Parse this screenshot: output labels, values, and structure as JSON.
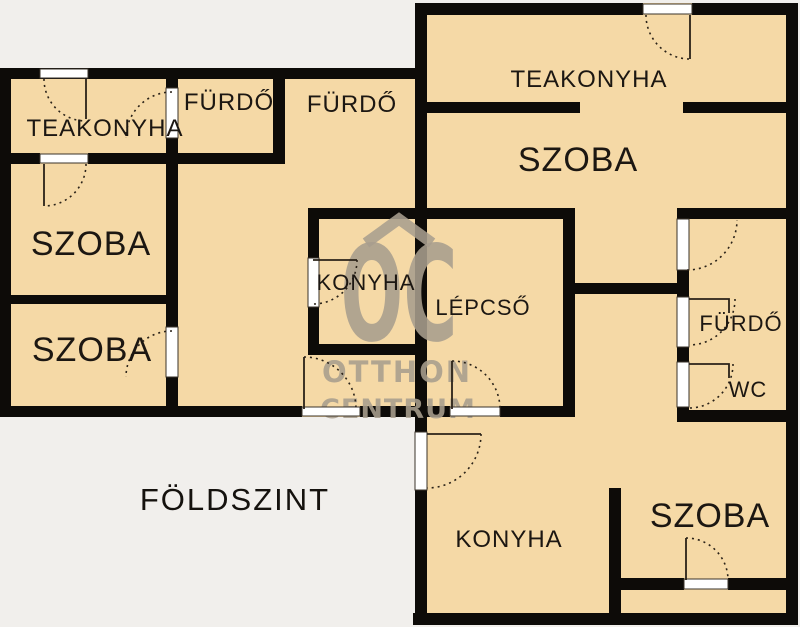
{
  "floor_plan": {
    "title": "FÖLDSZINT",
    "watermark": {
      "monogram": "OC",
      "line1": "OTTHON",
      "line2": "CENTRUM"
    },
    "rooms": [
      {
        "id": "teakonyha-left",
        "label": "TEAKONYHA"
      },
      {
        "id": "furdo-top-1",
        "label": "FÜRDŐ"
      },
      {
        "id": "furdo-top-2",
        "label": "FÜRDŐ"
      },
      {
        "id": "szoba-left-1",
        "label": "SZOBA"
      },
      {
        "id": "szoba-left-2",
        "label": "SZOBA"
      },
      {
        "id": "teakonyha-right",
        "label": "TEAKONYHA"
      },
      {
        "id": "szoba-right",
        "label": "SZOBA"
      },
      {
        "id": "konyha-center",
        "label": "KONYHA"
      },
      {
        "id": "lepcso",
        "label": "LÉPCSŐ"
      },
      {
        "id": "furdo-right",
        "label": "FÜRDŐ"
      },
      {
        "id": "wc",
        "label": "WC"
      },
      {
        "id": "konyha-bottom",
        "label": "KONYHA"
      },
      {
        "id": "szoba-bottom",
        "label": "SZOBA"
      }
    ],
    "colors": {
      "background": "#f1efec",
      "floor": "#f5d9a6",
      "wall": "#0d0b08",
      "door": "#ffffff",
      "swing_line": "#2a2218",
      "watermark": "#a89e8e",
      "label_text": "#1c1712"
    }
  }
}
